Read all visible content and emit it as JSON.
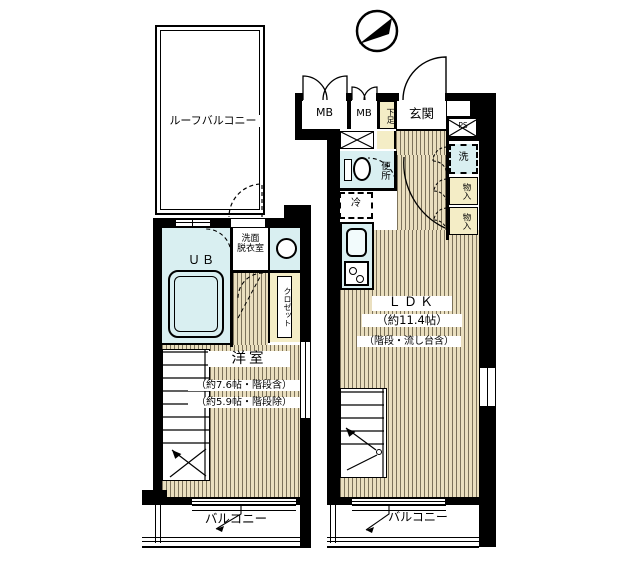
{
  "title": "間取り図",
  "colors": {
    "wall": "#000000",
    "floor_bg": "#eadfbf",
    "floor_line": "#4e4430",
    "wet_room": "#d9eff1",
    "storage": "#f4edc6",
    "background": "#ffffff"
  },
  "icons": {
    "compass": "north-arrow",
    "ps_box": "pipe-shaft-x",
    "bathtub": "bathtub",
    "toilet": "toilet",
    "washbasin": "round-basin",
    "kitchen": "sink-and-stove"
  },
  "left": {
    "roof_balcony": "ルーフバルコニー",
    "ub": "ＵＢ",
    "washroom_l1": "洗面",
    "washroom_l2": "脱衣室",
    "closet": "クロゼット",
    "room": "洋室",
    "room_size_incl": "（約7.6帖・階段含）",
    "room_size_excl": "（約5.9帖・階段除）",
    "balcony": "バルコニー"
  },
  "right": {
    "mb1": "MB",
    "mb2": "MB",
    "shoe": "下足",
    "entrance": "玄関",
    "ps": "PS",
    "toilet": "便所",
    "fridge": "冷",
    "washer": "洗",
    "storage1": "物入",
    "storage2": "物入",
    "ldk": "ＬＤＫ",
    "ldk_size": "（約11.4帖）",
    "ldk_note": "（階段・流し台含）",
    "balcony": "バルコニー"
  }
}
